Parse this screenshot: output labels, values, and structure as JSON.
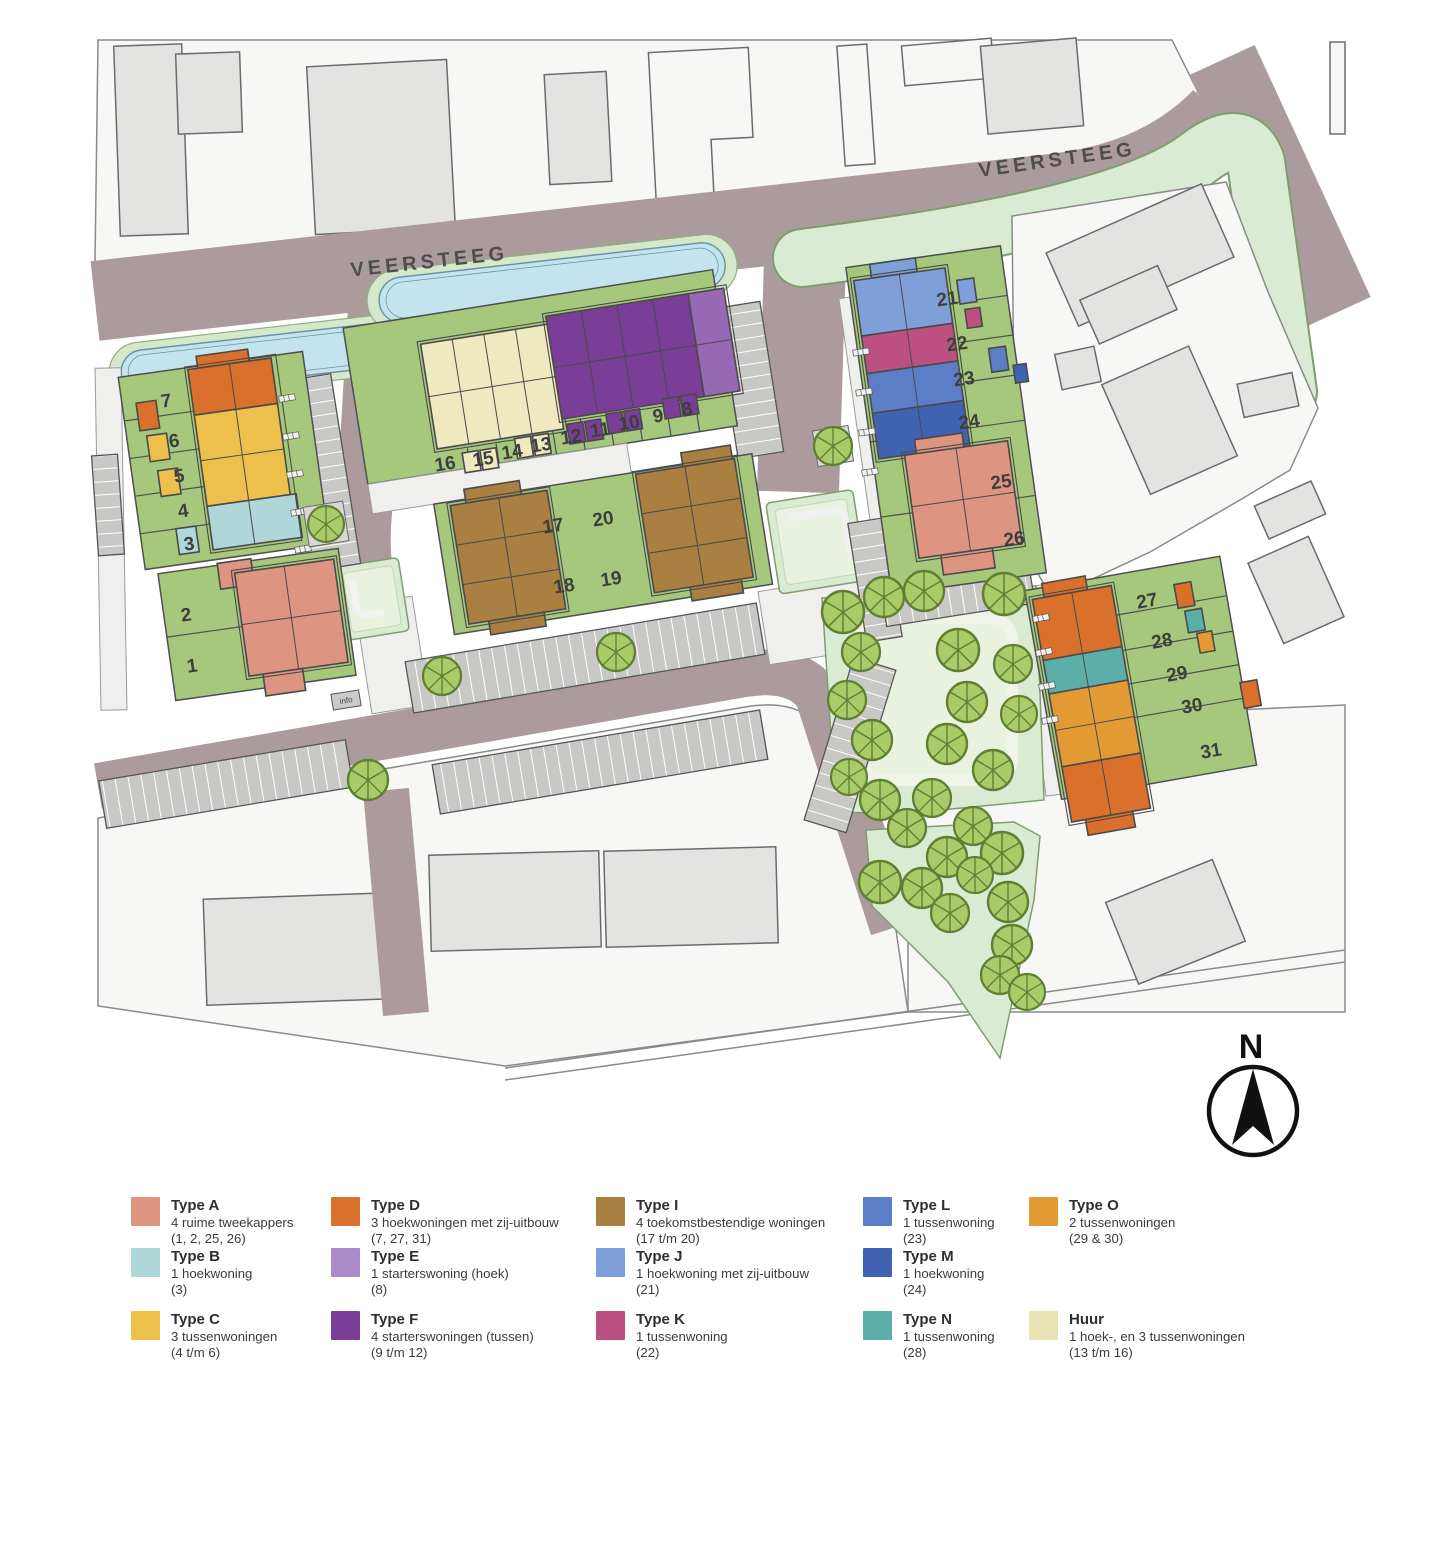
{
  "map": {
    "street_labels": [
      "VEERSTEEG",
      "VEERSTEEG"
    ],
    "plots": [
      "1",
      "2",
      "3",
      "4",
      "5",
      "6",
      "7",
      "8",
      "9",
      "10",
      "11",
      "12",
      "13",
      "14",
      "15",
      "16",
      "17",
      "18",
      "19",
      "20",
      "21",
      "22",
      "23",
      "24",
      "25",
      "26",
      "27",
      "28",
      "29",
      "30",
      "31"
    ],
    "info_sign": "info",
    "compass_label": "N"
  },
  "colors": {
    "street": "#AC9B9D",
    "plot_green": "#A6C87D",
    "verge_green": "#D9EBD3",
    "water": "#C4E3EF",
    "existing_building": "#E3E3E2"
  },
  "legend": {
    "items": [
      {
        "name": "Type A",
        "description": "4 ruime tweekappers",
        "plots": "(1, 2, 25, 26)",
        "color": "#DD9480"
      },
      {
        "name": "Type B",
        "description": "1 hoekwoning",
        "plots": "(3)",
        "color": "#AFD6D9"
      },
      {
        "name": "Type C",
        "description": "3 tussenwoningen",
        "plots": "(4 t/m 6)",
        "color": "#ECC04B"
      },
      {
        "name": "Type D",
        "description": "3 hoekwoningen met zij-uitbouw",
        "plots": "(7, 27, 31)",
        "color": "#D9702C"
      },
      {
        "name": "Type E",
        "description": "1 starterswoning (hoek)",
        "plots": "(8)",
        "color": "#AC8CC8"
      },
      {
        "name": "Type F",
        "description": "4 starterswoningen (tussen)",
        "plots": "(9 t/m 12)",
        "color": "#7A3E98"
      },
      {
        "name": "Type I",
        "description": "4 toekomstbestendige woningen",
        "plots": "(17 t/m 20)",
        "color": "#A97F42"
      },
      {
        "name": "Type J",
        "description": "1 hoekwoning met zij-uitbouw",
        "plots": "(21)",
        "color": "#7E9FD8"
      },
      {
        "name": "Type K",
        "description": "1 tussenwoning",
        "plots": "(22)",
        "color": "#BC5181"
      },
      {
        "name": "Type L",
        "description": "1 tussenwoning",
        "plots": "(23)",
        "color": "#5B7EC7"
      },
      {
        "name": "Type M",
        "description": "1 hoekwoning",
        "plots": "(24)",
        "color": "#3F63B0"
      },
      {
        "name": "Type N",
        "description": "1 tussenwoning",
        "plots": "(28)",
        "color": "#5BAFA8"
      },
      {
        "name": "Type O",
        "description": "2 tussenwoningen",
        "plots": "(29 & 30)",
        "color": "#E39A35"
      },
      {
        "name": "Huur",
        "description": "1 hoek-, en 3 tussenwoningen",
        "plots": "(13 t/m 16)",
        "color": "#E7E3B5"
      }
    ]
  }
}
